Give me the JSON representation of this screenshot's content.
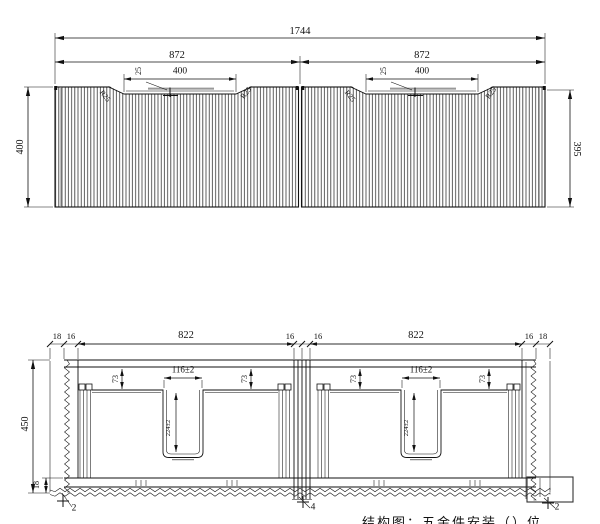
{
  "top_view": {
    "overall_width": "1744",
    "half_width": "872",
    "recess_width": "400",
    "recess_depth": "25",
    "corner_radius": "R25",
    "height_left": "400",
    "height_right": "395"
  },
  "section_view": {
    "side_overhang": "18",
    "panel_thickness": "16",
    "bay_width": "822",
    "cabinet_height": "450",
    "bottom_thickness": "18",
    "divider_offset": "73",
    "slot_width": "116±2",
    "slot_depth": "224±2",
    "callout_left": "2",
    "callout_center": "4",
    "callout_right": "2"
  },
  "caption": "结构图：五金件安装（）位"
}
